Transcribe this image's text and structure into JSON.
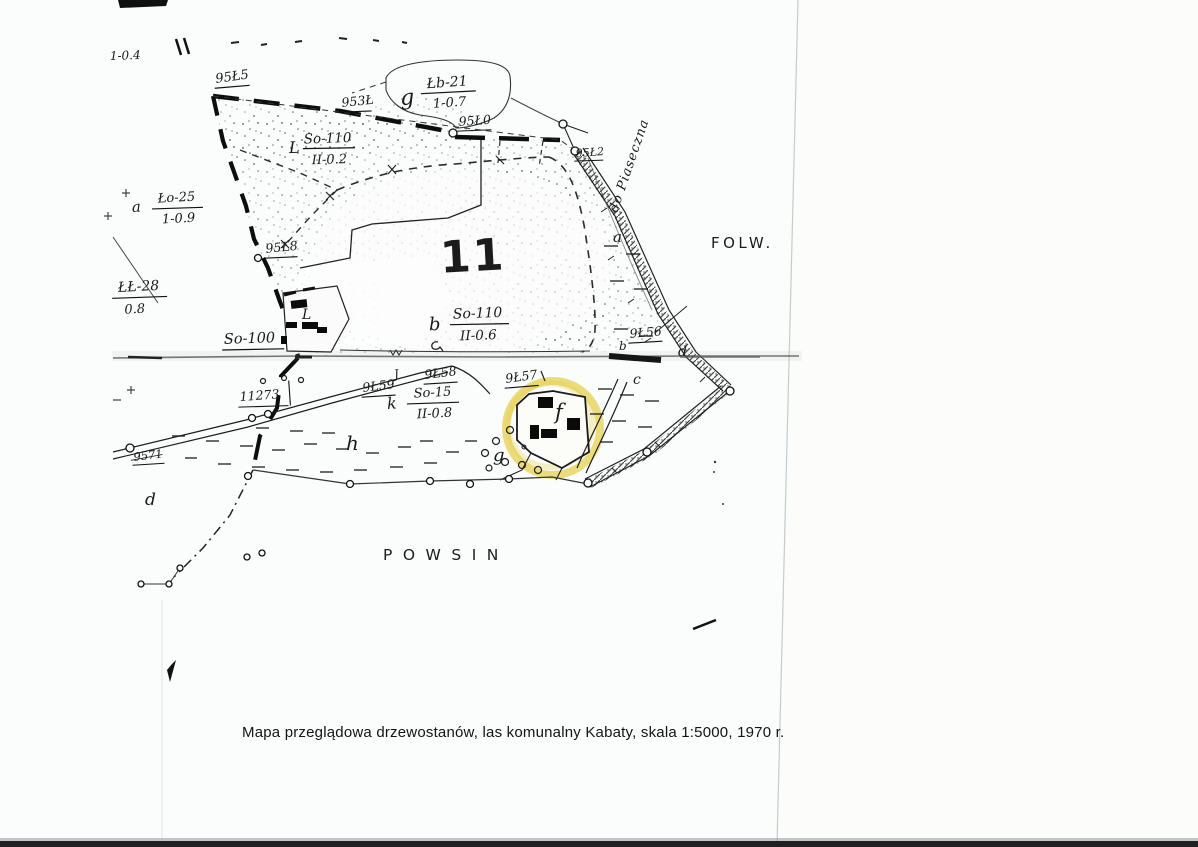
{
  "caption": "Mapa przeglądowa drzewostanów, las komunalny Kabaty, skala 1:5000, 1970 r.",
  "map": {
    "compartment_number": "11",
    "region_folw": "FOLW.",
    "region_powsin": "POWSIN",
    "road_label": "do Piaseczna",
    "edge_fragment": "1-0.4",
    "highlight_color": "#e4ce45",
    "stands": {
      "g_letter": "g",
      "g_num": "Łb-21",
      "g_den": "1-0.7",
      "l_letter": "L",
      "l_num": "So-110",
      "l_den": "II-0.2",
      "a_letter": "a",
      "a_num": "Ło-25",
      "a_den": "1-0.9",
      "e_num": "ŁŁ-28",
      "e_den": "0.8",
      "b_letter": "b",
      "b_num": "So-110",
      "b_den": "II-0.6",
      "k_letter": "k",
      "k_num": "So-15",
      "k_den": "II-0.8",
      "so100": "So-100"
    },
    "points": {
      "p9545": "95Ł5",
      "p9534": "953Ł",
      "p9540": "95Ł0",
      "p9542": "95Ł2",
      "p9548": "95Ł8",
      "p9456": "9Ł56",
      "p9457": "9Ł57",
      "p9458": "9Ł58",
      "p9459": "9Ł59",
      "p9571": "9571",
      "p11273": "11273"
    },
    "letters": {
      "a": "a",
      "b": "b",
      "c": "c",
      "d1": "d",
      "d2": "d",
      "f": "f",
      "g": "g",
      "h": "h",
      "j": "J",
      "l": "L"
    }
  }
}
